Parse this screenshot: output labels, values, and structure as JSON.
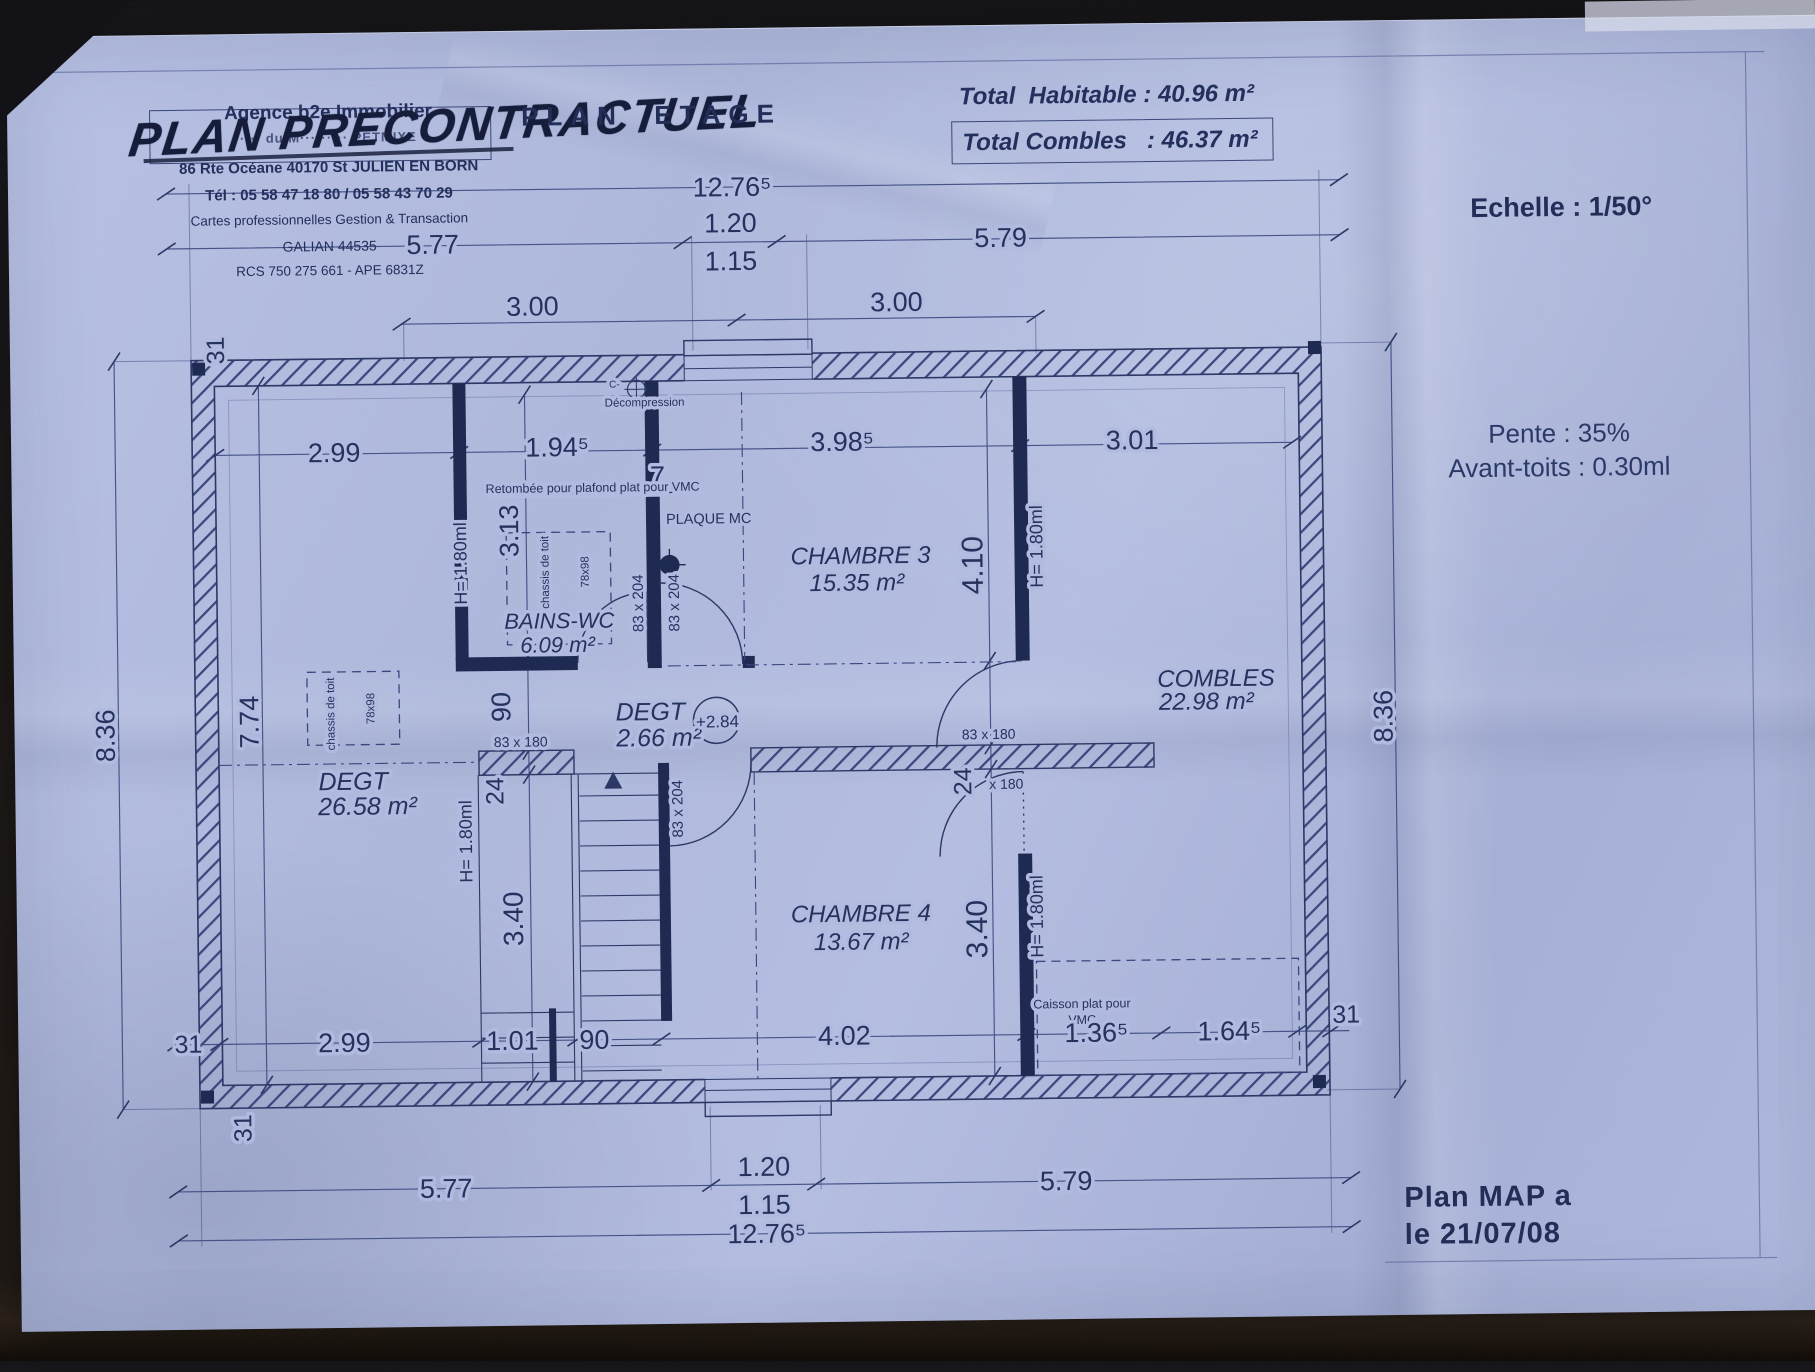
{
  "colors": {
    "paper": "#b1bbdf",
    "ink": "#27335f",
    "wall": "#1e2a52"
  },
  "agency": {
    "name": "Agence b2e Immobilier",
    "obscured_line": "···· du M········· PETMIXE",
    "address": "86 Rte Océane 40170 St JULIEN EN BORN",
    "phone": "Tél : 05 58 47 18 80 / 05 58 43 70 29",
    "cards": "Cartes professionnelles Gestion & Transaction",
    "galian": "GALIAN 44535",
    "rcs": "RCS 750 275 661 - APE 6831Z"
  },
  "header": {
    "handwritten": "PLAN PRECONTRACTUEL",
    "title": "PLAN  ETAGE",
    "total_habitable": "Total  Habitable : 40.96 m²",
    "total_combles": "Total Combles   : 46.37 m²",
    "echelle": "Echelle : 1/50°"
  },
  "notes": {
    "pente": "Pente : 35%",
    "avant_toits": "Avant-toits : 0.30ml",
    "plan_ref": "Plan MAP a",
    "plan_date": "le 21/07/08"
  },
  "plan": {
    "labels": [
      {
        "t": "12.76⁵",
        "x": 738,
        "y": 194,
        "s": 27
      },
      {
        "t": "1.20",
        "x": 736,
        "y": 230,
        "s": 27
      },
      {
        "t": "1.15",
        "x": 736,
        "y": 268,
        "s": 27
      },
      {
        "t": "5.77",
        "x": 438,
        "y": 248,
        "s": 27
      },
      {
        "t": "5.79",
        "x": 1006,
        "y": 248,
        "s": 27
      },
      {
        "t": "3.00",
        "x": 537,
        "y": 311,
        "s": 27
      },
      {
        "t": "3.00",
        "x": 901,
        "y": 311,
        "s": 27
      },
      {
        "t": "2.99",
        "x": 337,
        "y": 455,
        "s": 27
      },
      {
        "t": "1.94⁵",
        "x": 560,
        "y": 452,
        "s": 27
      },
      {
        "t": "7",
        "x": 660,
        "y": 482,
        "s": 27
      },
      {
        "t": "3.98⁵",
        "x": 845,
        "y": 450,
        "s": 27
      },
      {
        "t": "3.01",
        "x": 1135,
        "y": 452,
        "s": 27
      },
      {
        "t": "31",
        "x": 228,
        "y": 342,
        "s": 25,
        "r": -90
      },
      {
        "t": "8.36",
        "x": 114,
        "y": 726,
        "s": 27,
        "r": -90
      },
      {
        "t": "7.74",
        "x": 258,
        "y": 714,
        "s": 27,
        "r": -90
      },
      {
        "t": "3.13",
        "x": 520,
        "y": 526,
        "s": 27,
        "r": -90
      },
      {
        "t": "H= 1.80ml",
        "x": 468,
        "y": 558,
        "s": 18,
        "r": -90
      },
      {
        "t": "H= 1.80ml",
        "x": 470,
        "y": 836,
        "s": 18,
        "r": -90
      },
      {
        "t": "90",
        "x": 510,
        "y": 702,
        "s": 27,
        "r": -90
      },
      {
        "t": "24",
        "x": 502,
        "y": 786,
        "s": 25,
        "r": -90
      },
      {
        "t": "3.40",
        "x": 520,
        "y": 914,
        "s": 28,
        "r": -90
      },
      {
        "t": "31",
        "x": 246,
        "y": 1120,
        "s": 25,
        "r": -90
      },
      {
        "t": "4.10",
        "x": 984,
        "y": 566,
        "s": 30,
        "r": -90
      },
      {
        "t": "H= 1.80ml",
        "x": 1044,
        "y": 548,
        "s": 18,
        "r": -90
      },
      {
        "t": "24",
        "x": 970,
        "y": 782,
        "s": 25,
        "r": -90
      },
      {
        "t": "3.40",
        "x": 984,
        "y": 930,
        "s": 30,
        "r": -90
      },
      {
        "t": "H= 1.80ml",
        "x": 1040,
        "y": 918,
        "s": 18,
        "r": -90
      },
      {
        "t": "8.36",
        "x": 1392,
        "y": 722,
        "s": 27,
        "r": -90
      },
      {
        "t": "83 x 204",
        "x": 644,
        "y": 600,
        "s": 15,
        "r": -90
      },
      {
        "t": "83 x 204",
        "x": 680,
        "y": 600,
        "s": 15,
        "r": -90
      },
      {
        "t": "83 x 204",
        "x": 681,
        "y": 806,
        "s": 15,
        "r": -90
      },
      {
        "t": "83 x 180",
        "x": 520,
        "y": 742,
        "s": 14
      },
      {
        "t": "83 x 180",
        "x": 988,
        "y": 740,
        "s": 14
      },
      {
        "t": "x 180",
        "x": 1005,
        "y": 790,
        "s": 14
      },
      {
        "t": "Retombée pour plafond plat pour VMC",
        "x": 488,
        "y": 488,
        "s": 12.5,
        "a": "s",
        "u": 1
      },
      {
        "t": "PLAQUE MC",
        "x": 668,
        "y": 521,
        "s": 14.5,
        "a": "s"
      },
      {
        "t": "Décompression",
        "x": 648,
        "y": 403,
        "s": 11.5
      },
      {
        "t": "C-",
        "x": 618,
        "y": 384,
        "s": 10
      },
      {
        "t": "chassis de toit",
        "x": 334,
        "y": 707,
        "s": 11.5,
        "r": -90
      },
      {
        "t": "78x98",
        "x": 374,
        "y": 702,
        "s": 11.5,
        "r": -90
      },
      {
        "t": "chassis de toit",
        "x": 550,
        "y": 568,
        "s": 11.5,
        "r": -90
      },
      {
        "t": "78x98",
        "x": 590,
        "y": 568,
        "s": 11.5,
        "r": -90
      },
      {
        "t": "Caisson plat pour",
        "x": 1078,
        "y": 1010,
        "s": 12.5
      },
      {
        "t": "VMC",
        "x": 1078,
        "y": 1026,
        "s": 12.5
      },
      {
        "t": "31",
        "x": 184,
        "y": 1044,
        "s": 25
      },
      {
        "t": "2.99",
        "x": 340,
        "y": 1045,
        "s": 27
      },
      {
        "t": "1.01",
        "x": 508,
        "y": 1045,
        "s": 27
      },
      {
        "t": "90",
        "x": 590,
        "y": 1045,
        "s": 27
      },
      {
        "t": "4.02",
        "x": 840,
        "y": 1044,
        "s": 27
      },
      {
        "t": "1.36⁵",
        "x": 1092,
        "y": 1044,
        "s": 27
      },
      {
        "t": "1.64⁵",
        "x": 1225,
        "y": 1044,
        "s": 27
      },
      {
        "t": "31",
        "x": 1342,
        "y": 1028,
        "s": 25
      },
      {
        "t": "5.77",
        "x": 440,
        "y": 1192,
        "s": 27
      },
      {
        "t": "1.20",
        "x": 758,
        "y": 1174,
        "s": 27
      },
      {
        "t": "1.15",
        "x": 758,
        "y": 1212,
        "s": 27
      },
      {
        "t": "5.79",
        "x": 1060,
        "y": 1192,
        "s": 27
      },
      {
        "t": "12.76⁵",
        "x": 760,
        "y": 1241,
        "s": 27
      },
      {
        "t": "CHAMBRE 3",
        "x": 862,
        "y": 563,
        "s": 24,
        "i": 1
      },
      {
        "t": "15.35 m²",
        "x": 858,
        "y": 590,
        "s": 24,
        "i": 1
      },
      {
        "t": "BAINS-WC",
        "x": 560,
        "y": 624,
        "s": 22,
        "i": 1
      },
      {
        "t": "6.09 m²",
        "x": 558,
        "y": 648,
        "s": 22,
        "i": 1
      },
      {
        "t": "DEGT",
        "x": 352,
        "y": 783,
        "s": 25,
        "i": 1
      },
      {
        "t": "26.58 m²",
        "x": 366,
        "y": 808,
        "s": 25,
        "i": 1
      },
      {
        "t": "DEGT",
        "x": 650,
        "y": 717,
        "s": 25,
        "i": 1
      },
      {
        "t": "2.66 m²",
        "x": 658,
        "y": 743,
        "s": 25,
        "i": 1
      },
      {
        "t": "+2.84",
        "x": 717,
        "y": 725,
        "s": 17
      },
      {
        "t": "COMBLES",
        "x": 1216,
        "y": 690,
        "s": 24,
        "i": 1
      },
      {
        "t": "22.98 m²",
        "x": 1206,
        "y": 713,
        "s": 24,
        "i": 1
      },
      {
        "t": "CHAMBRE 4",
        "x": 858,
        "y": 921,
        "s": 24,
        "i": 1
      },
      {
        "t": "13.67 m²",
        "x": 858,
        "y": 949,
        "s": 24,
        "i": 1
      }
    ]
  }
}
